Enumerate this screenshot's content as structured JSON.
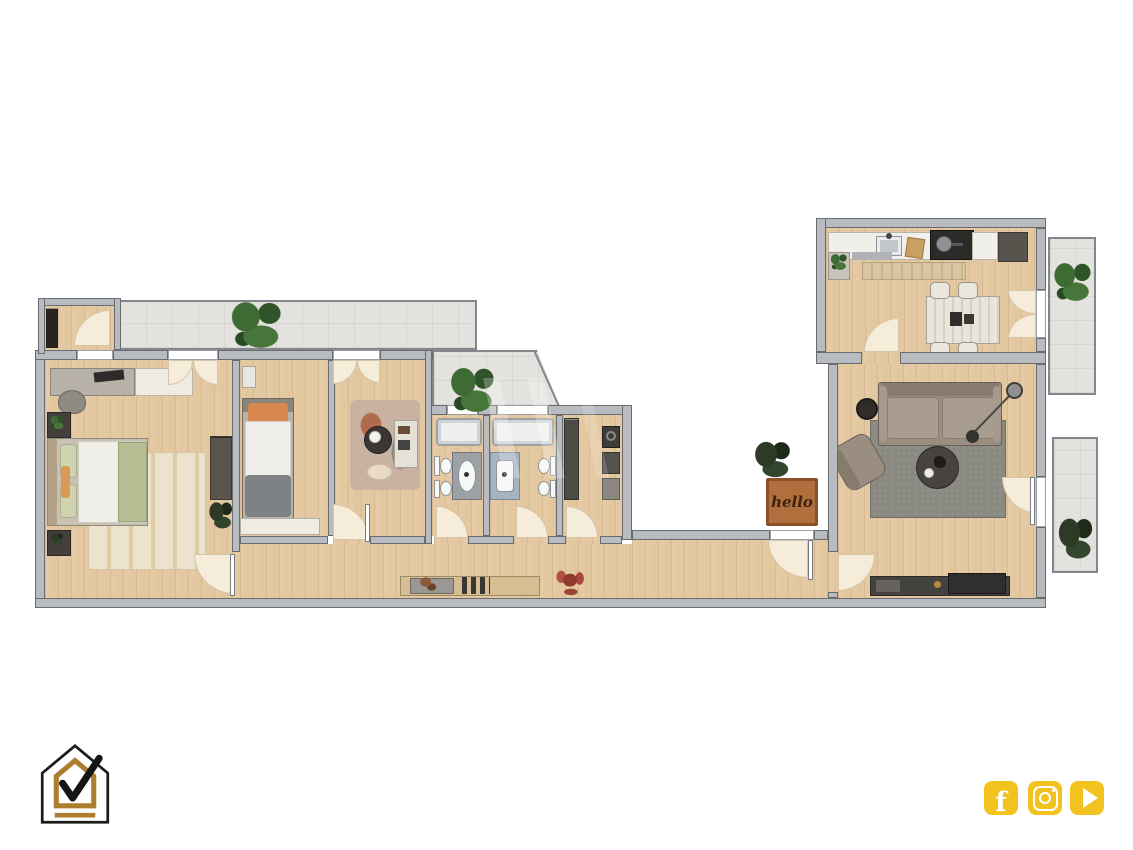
{
  "entrance": {
    "mat_text": "hello"
  },
  "branding": {
    "logo": {
      "name": "house-check-logo",
      "outline_color": "#1c1c1c",
      "accent_color": "#ab7f2e"
    },
    "social": {
      "background": "#f2c21f",
      "items": [
        {
          "name": "facebook-icon",
          "glyph": "f"
        },
        {
          "name": "instagram-icon",
          "glyph": ""
        },
        {
          "name": "youtube-icon",
          "glyph": ""
        }
      ]
    }
  },
  "floor_plan": {
    "rooms": [
      {
        "name": "storage-room",
        "furniture": [
          "shelf"
        ]
      },
      {
        "name": "bedroom-1",
        "furniture": [
          "desk",
          "office-chair",
          "sideboard",
          "double-bed",
          "nightstand",
          "nightstand",
          "rug",
          "wardrobe",
          "plant"
        ]
      },
      {
        "name": "bedroom-2",
        "furniture": [
          "single-bed",
          "radiator",
          "dresser"
        ]
      },
      {
        "name": "bedroom-3",
        "furniture": [
          "rug",
          "round-table",
          "desk"
        ]
      },
      {
        "name": "bathroom-1",
        "furniture": [
          "bathtub",
          "toilet",
          "bidet",
          "washbasin"
        ]
      },
      {
        "name": "bathroom-2",
        "furniture": [
          "bathtub",
          "toilet",
          "bidet",
          "washbasin"
        ]
      },
      {
        "name": "laundry-room",
        "furniture": [
          "shelving",
          "washing-machine",
          "dryer",
          "shelf"
        ]
      },
      {
        "name": "hallway",
        "furniture": [
          "console-table",
          "planter-tray",
          "books",
          "red-plant",
          "doormat"
        ]
      },
      {
        "name": "kitchen",
        "furniture": [
          "counter",
          "sink",
          "cutting-board",
          "cooktop",
          "refrigerator",
          "counter-plant",
          "mat",
          "rug",
          "dining-table",
          "chair",
          "chair",
          "chair",
          "chair"
        ]
      },
      {
        "name": "living-room",
        "furniture": [
          "sofa",
          "armchair",
          "side-table",
          "coffee-table",
          "floor-lamp",
          "rug",
          "tv-unit"
        ]
      },
      {
        "name": "balcony-top",
        "furniture": [
          "plant",
          "plant"
        ]
      },
      {
        "name": "balcony-kitchen",
        "furniture": [
          "plant"
        ]
      },
      {
        "name": "balcony-living",
        "furniture": [
          "plant"
        ]
      }
    ]
  },
  "palette": {
    "wall": "#b8bcc0",
    "wall_line": "#686c70",
    "wood": "#e3c79f",
    "tile": "#e3e2de",
    "arc": "#f5ecda",
    "arc_line": "#d6c6a8",
    "yellow": "#f2c21f",
    "gold": "#ab7f2e",
    "mat": "#b06f3c",
    "mat_line": "#8a5226",
    "rug_beige": "#ece3cd",
    "rug_gray": "#8b8a82"
  }
}
